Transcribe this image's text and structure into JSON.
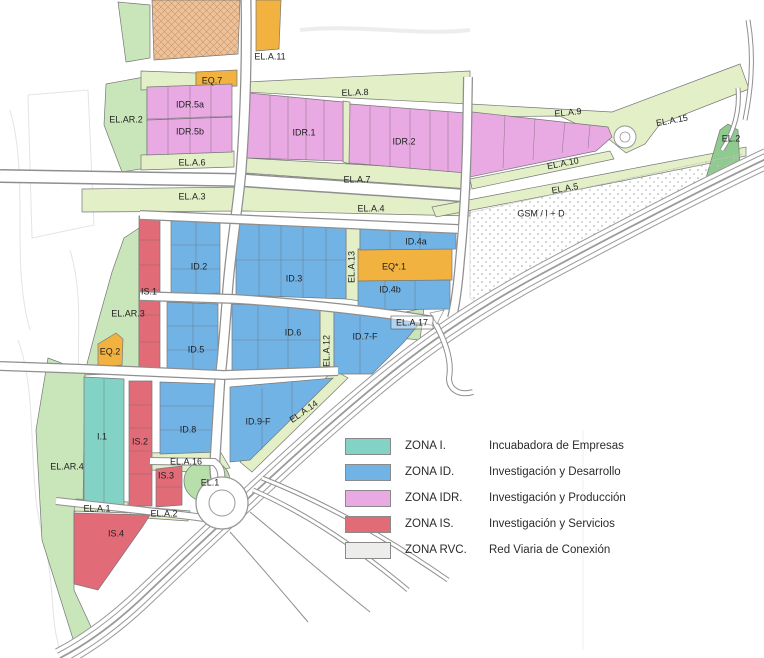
{
  "document": {
    "type": "urban zoning plan (technology park land-use map)",
    "language": "Spanish"
  },
  "colors": {
    "zone_I": "#82d3c6",
    "zone_ID": "#72b3e6",
    "zone_IDR": "#e9a9e3",
    "zone_IS": "#e26b78",
    "zone_RVC": "#ededeb",
    "open_space_light": "#e2efc7",
    "open_space": "#c9e6ba",
    "open_space_dark": "#8fcb8e",
    "el1_green": "#b7dfa9",
    "equipment_orange": "#f2b240",
    "hatch_tan": "#ecc29a",
    "road_gray": "#8f8f8f",
    "label_color": "#1f1f1f"
  },
  "legend": {
    "rows": [
      {
        "zone": "ZONA I.",
        "description": "Incuabadora de Empresas",
        "color_key": "zone_I"
      },
      {
        "zone": "ZONA ID.",
        "description": "Investigación y Desarrollo",
        "color_key": "zone_ID"
      },
      {
        "zone": "ZONA IDR.",
        "description": "Investigación y Producción",
        "color_key": "zone_IDR"
      },
      {
        "zone": "ZONA IS.",
        "description": "Investigación y Servicios",
        "color_key": "zone_IS"
      },
      {
        "zone": "ZONA RVC.",
        "description": "Red Viaria de Conexión",
        "color_key": "zone_RVC"
      }
    ]
  },
  "map_labels": [
    {
      "text": "EL.A.11",
      "x": 270,
      "y": 57
    },
    {
      "text": "EQ.7",
      "x": 212,
      "y": 81
    },
    {
      "text": "IDR.5a",
      "x": 190,
      "y": 105
    },
    {
      "text": "IDR.5b",
      "x": 190,
      "y": 132
    },
    {
      "text": "EL.AR.2",
      "x": 126,
      "y": 120
    },
    {
      "text": "EL.A.6",
      "x": 192,
      "y": 163
    },
    {
      "text": "EL.A.8",
      "x": 355,
      "y": 93,
      "rot": -2
    },
    {
      "text": "IDR.1",
      "x": 304,
      "y": 133
    },
    {
      "text": "IDR.2",
      "x": 404,
      "y": 142
    },
    {
      "text": "EL.A.9",
      "x": 568,
      "y": 113,
      "rot": -6
    },
    {
      "text": "EL.A.15",
      "x": 672,
      "y": 121,
      "rot": -10
    },
    {
      "text": "EL.2",
      "x": 731,
      "y": 139
    },
    {
      "text": "EL.A.10",
      "x": 563,
      "y": 164,
      "rot": -11
    },
    {
      "text": "EL.A.5",
      "x": 565,
      "y": 189,
      "rot": -10
    },
    {
      "text": "EL.A.7",
      "x": 357,
      "y": 180
    },
    {
      "text": "EL.A.3",
      "x": 192,
      "y": 197
    },
    {
      "text": "EL.A.4",
      "x": 371,
      "y": 209
    },
    {
      "text": "GSM / I + D",
      "x": 541,
      "y": 214
    },
    {
      "text": "ID.2",
      "x": 199,
      "y": 267
    },
    {
      "text": "ID.3",
      "x": 294,
      "y": 279
    },
    {
      "text": "EL.A.13",
      "x": 352,
      "y": 267,
      "rot": -90
    },
    {
      "text": "ID.4a",
      "x": 416,
      "y": 242
    },
    {
      "text": "EQ*.1",
      "x": 394,
      "y": 267
    },
    {
      "text": "ID.4b",
      "x": 390,
      "y": 290
    },
    {
      "text": "IS.1",
      "x": 149,
      "y": 292
    },
    {
      "text": "EL.AR.3",
      "x": 128,
      "y": 314
    },
    {
      "text": "EQ.2",
      "x": 110,
      "y": 352
    },
    {
      "text": "ID.5",
      "x": 196,
      "y": 350
    },
    {
      "text": "ID.6",
      "x": 293,
      "y": 333
    },
    {
      "text": "EL.A.12",
      "x": 327,
      "y": 351,
      "rot": -90
    },
    {
      "text": "ID.7-F",
      "x": 365,
      "y": 337
    },
    {
      "text": "EL.A.17",
      "x": 412,
      "y": 323,
      "box": true
    },
    {
      "text": "I.1",
      "x": 102,
      "y": 437
    },
    {
      "text": "IS.2",
      "x": 140,
      "y": 442
    },
    {
      "text": "ID.8",
      "x": 188,
      "y": 430
    },
    {
      "text": "ID.9-F",
      "x": 258,
      "y": 422
    },
    {
      "text": "EL.A.14",
      "x": 304,
      "y": 412,
      "rot": -35
    },
    {
      "text": "EL.AR.4",
      "x": 67,
      "y": 467
    },
    {
      "text": "EL.A.16",
      "x": 186,
      "y": 462
    },
    {
      "text": "IS.3",
      "x": 166,
      "y": 476
    },
    {
      "text": "EL.1",
      "x": 210,
      "y": 483
    },
    {
      "text": "EL.A.1",
      "x": 97,
      "y": 509
    },
    {
      "text": "EL.A.2",
      "x": 164,
      "y": 514
    },
    {
      "text": "IS.4",
      "x": 116,
      "y": 534
    }
  ]
}
